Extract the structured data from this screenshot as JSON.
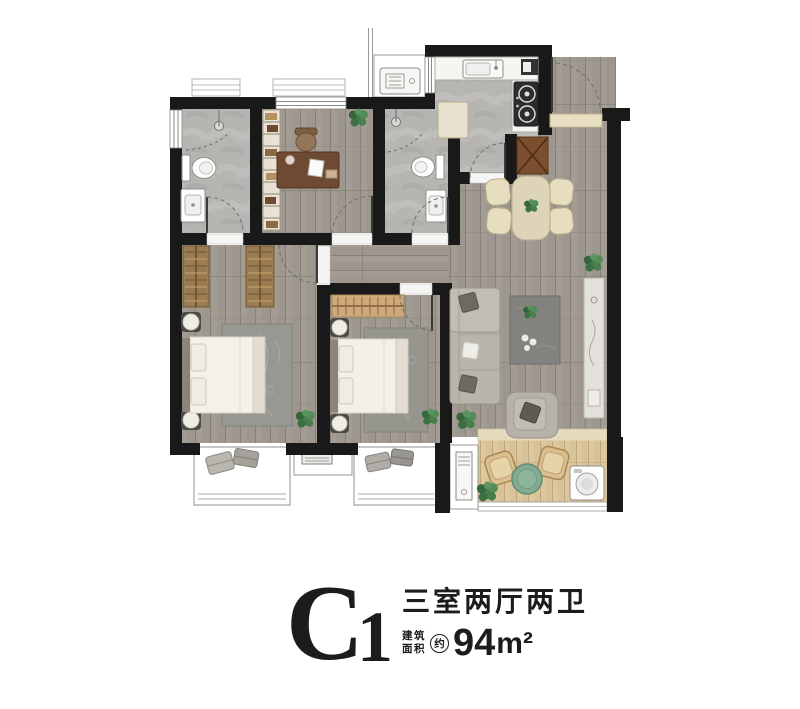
{
  "plan_title": {
    "code_letter": "C",
    "code_number": "1",
    "layout_text": "三室两厅两卫",
    "area_label_top": "建筑",
    "area_label_bottom": "面积",
    "area_approx": "约",
    "area_value": "94",
    "area_unit": "m²"
  },
  "colors": {
    "wall": "#191919",
    "wood_floor": "#a29c94",
    "tile_floor": "#b7b5b2",
    "balcony_floor": "#dcc79f",
    "furniture_beige": "#ded5b8",
    "furniture_brown": "#7a4e2e",
    "plant_green": "#47804d",
    "text": "#1c1c1c"
  }
}
